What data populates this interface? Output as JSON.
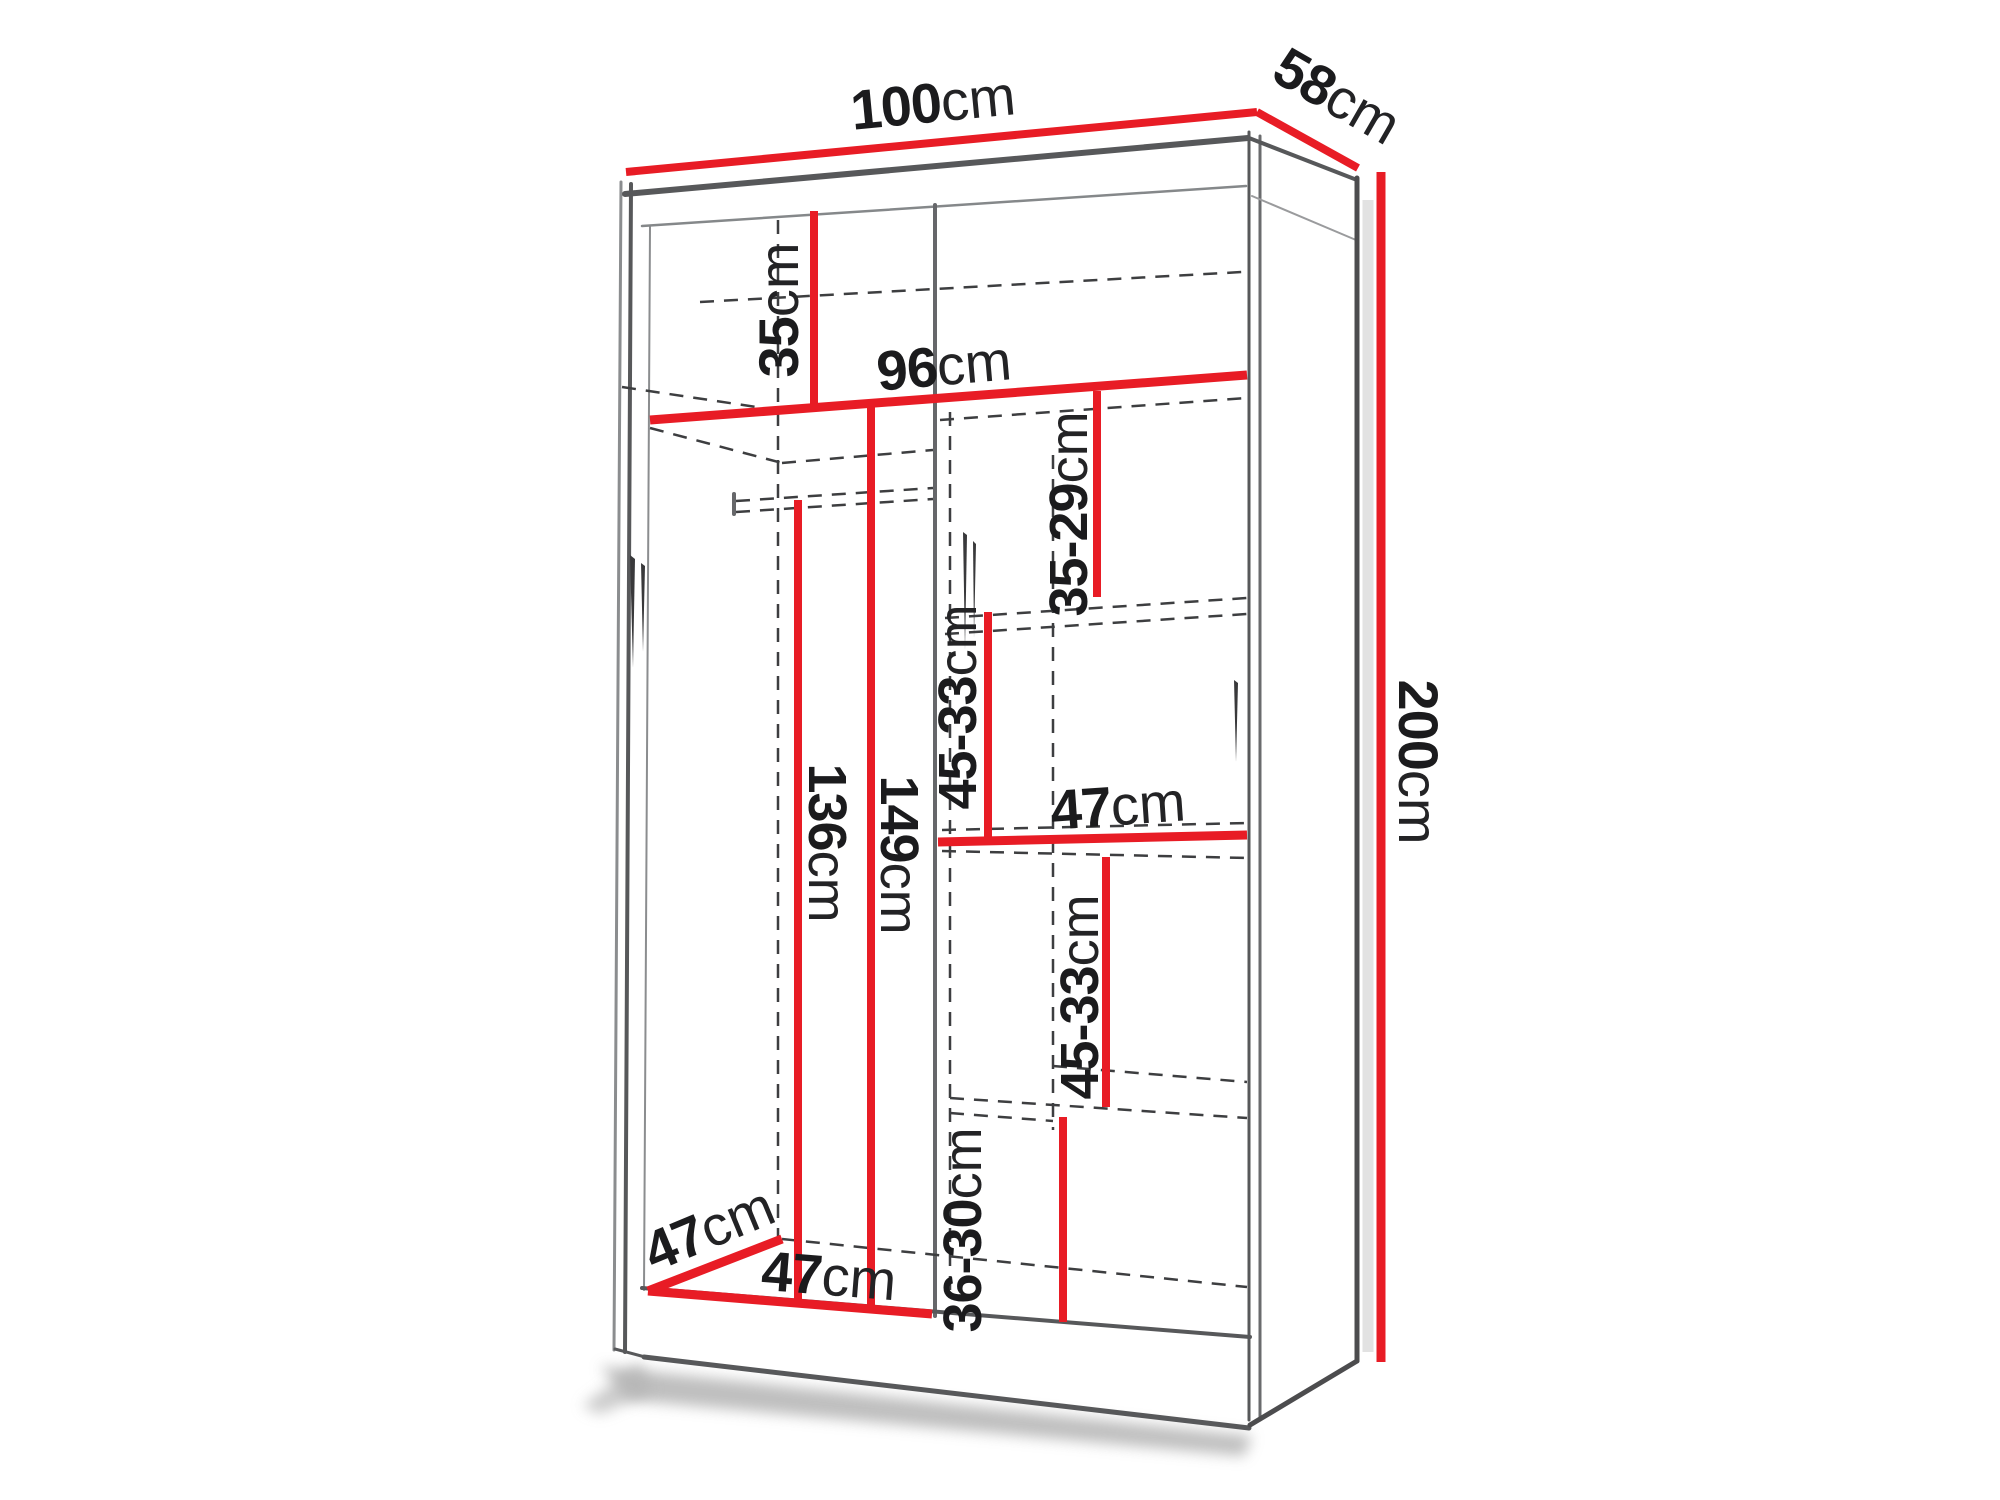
{
  "colors": {
    "dimension_line": "#e81c25",
    "structure_line": "#57585a",
    "hidden_line": "#3d3e40",
    "text": "#1b1b1d"
  },
  "labels": {
    "width": {
      "value": "100",
      "unit": "cm"
    },
    "depth": {
      "value": "58",
      "unit": "cm"
    },
    "height": {
      "value": "200",
      "unit": "cm"
    },
    "top_compartment": {
      "value": "35",
      "unit": "cm"
    },
    "interior_width": {
      "value": "96",
      "unit": "cm"
    },
    "upper_right_gap": {
      "value": "35-29",
      "unit": "cm"
    },
    "mid_right_gap": {
      "value": "45-33",
      "unit": "cm"
    },
    "right_shelf_width": {
      "value": "47",
      "unit": "cm"
    },
    "rail_height": {
      "value": "136",
      "unit": "cm"
    },
    "left_interior_height": {
      "value": "149",
      "unit": "cm"
    },
    "lower_right_gap": {
      "value": "45-33",
      "unit": "cm"
    },
    "bottom_right_gap": {
      "value": "36-30",
      "unit": "cm"
    },
    "interior_depth": {
      "value": "47",
      "unit": "cm"
    },
    "left_section_width": {
      "value": "47",
      "unit": "cm"
    }
  }
}
